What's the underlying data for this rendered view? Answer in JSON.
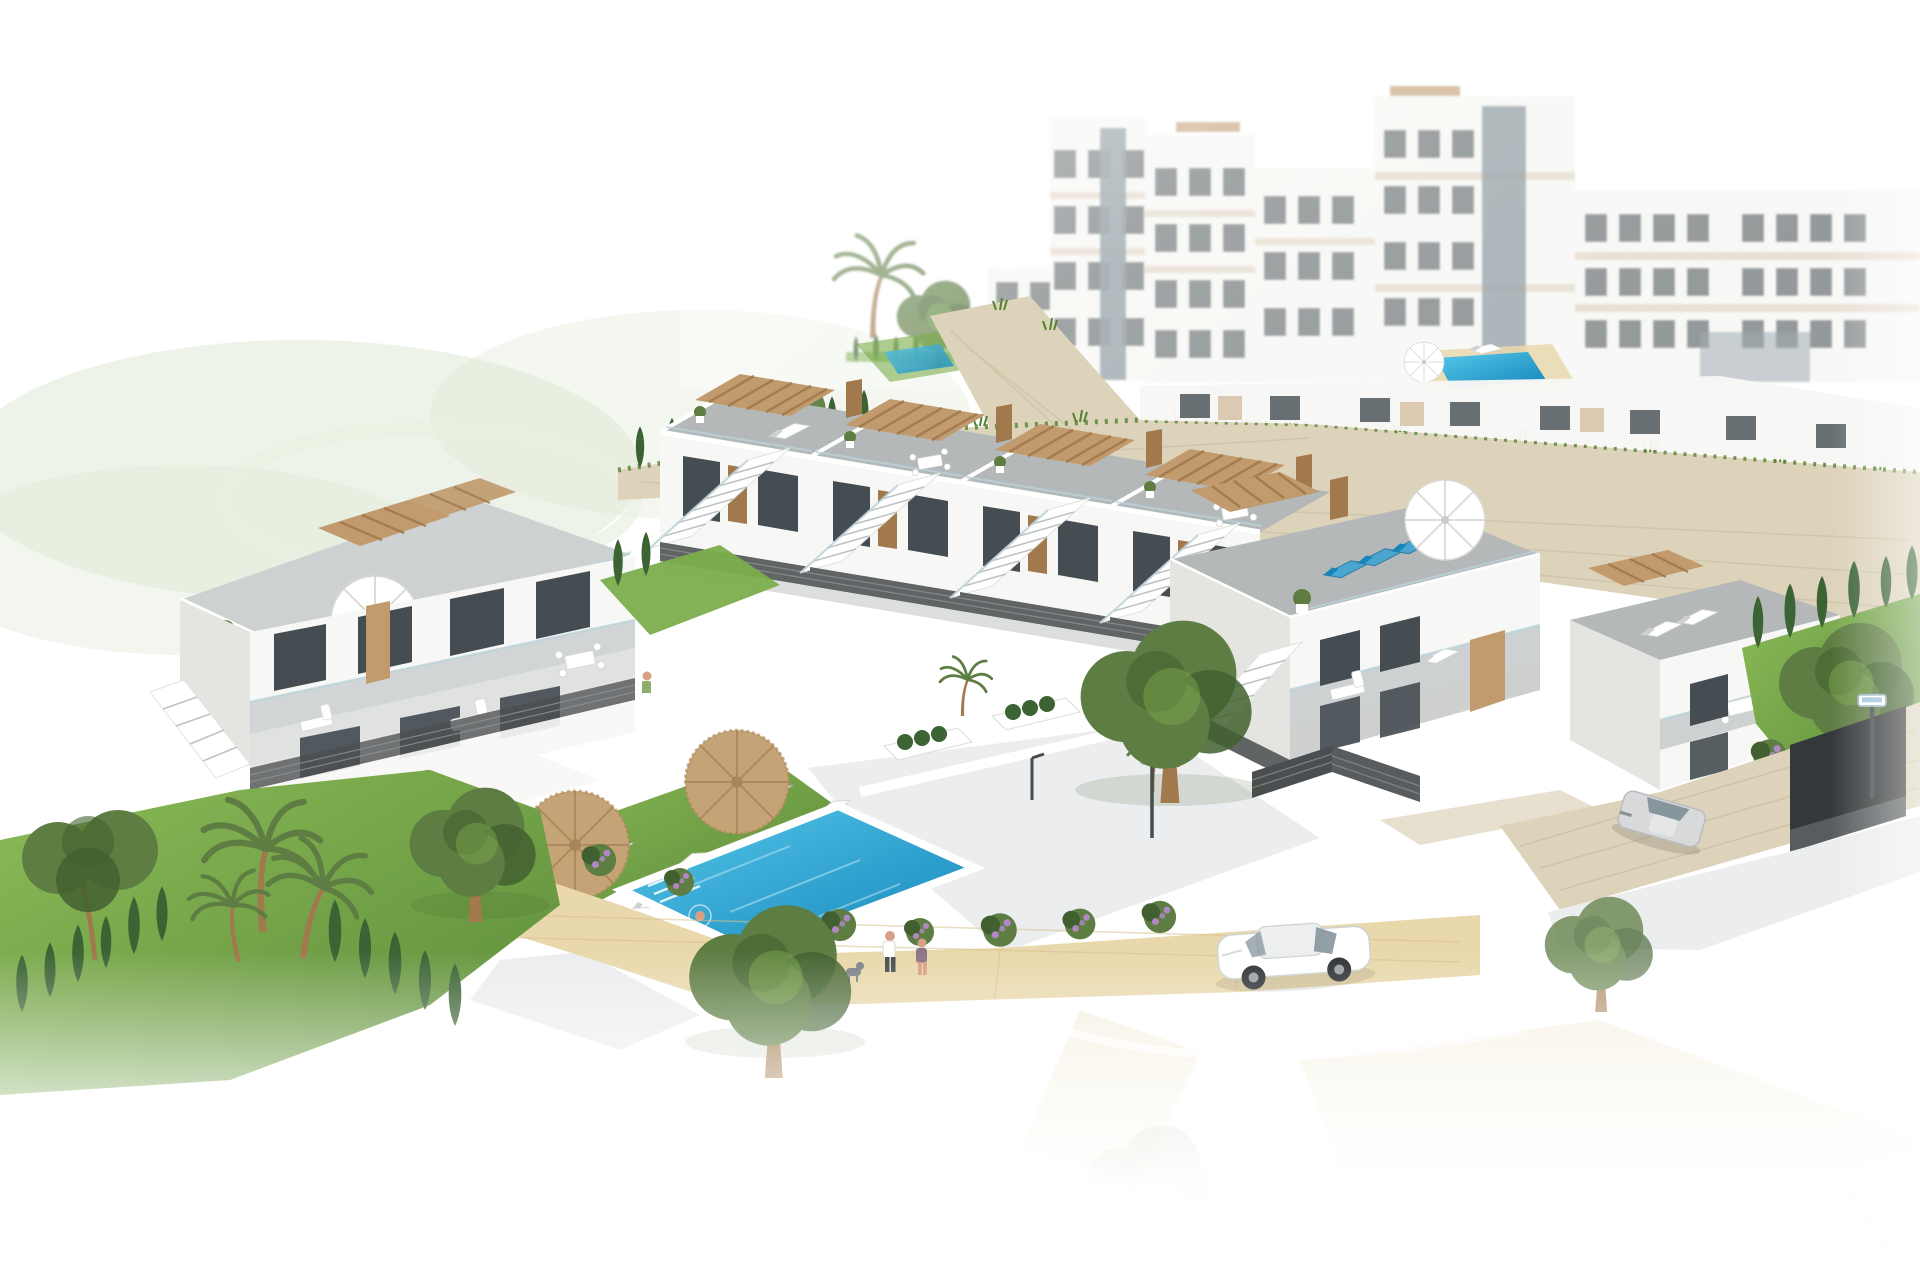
{
  "meta": {
    "type": "architectural-3d-render",
    "subject": "Aerial 3D rendering of a modern white townhouse development on a hillside with roof terraces, wooden pergolas, a communal turquoise pool, landscaped gardens, a street with cars and hazy apartment blocks in the background; edges fade to white",
    "style": "photorealistic CGI marketing visual, white vignette background",
    "camera": "high-angle aerial, isometric-like"
  },
  "colors": {
    "bg": "#ffffff",
    "facade": "#f7f7f5",
    "facadeShade": "#e4e4e1",
    "facadeDark": "#d3d3d0",
    "glass": "#454d52",
    "glassLight": "#87959c",
    "wood": "#c19b6e",
    "woodDark": "#a2794c",
    "deck": "#b4b8b9",
    "deckLight": "#ced1d1",
    "stone": "#ddd3bb",
    "stoneDark": "#c4b795",
    "lawn": "#7cad4c",
    "lawnDark": "#53822f",
    "golf": "#dfe9d5",
    "tree": "#5e7d43",
    "treeDark": "#42602f",
    "cypress": "#3b6334",
    "pool": "#2ba8d8",
    "poolDeep": "#1584b8",
    "sand": "#e9d8ab",
    "sandDark": "#d8c18c",
    "umbrella": "#c4a377",
    "umbrellaDark": "#a88659",
    "fence": "#4b4e50",
    "road": "#ecedee",
    "carSilver": "#d7d9db",
    "skin": "#d8a084",
    "bikini": "#e2519c",
    "flower": "#b287c4",
    "loungerBlue": "#4aa6d0",
    "rail": "#b9d2da"
  },
  "labels": {
    "scene": "Residential development aerial render",
    "background_apartments": "Hazy multi-storey apartment blocks in the background",
    "rooftop_mini_pool": "Rooftop terrace plunge pool with deck",
    "upper_garden": "Small upper garden with plunge pool",
    "retaining_wall": "Natural stone retaining walls with wild grasses",
    "back_house_band": "Second row of homes behind the stone wall",
    "townhouse_row": "Front row of white townhouses with roof solariums and wooden pergolas",
    "end_house": "Corner townhouse with wrap-around roof terrace, blue loungers and white parasol",
    "right_house": "Right-hand townhouse with stacked terraces",
    "right_garden": "Private garden with cypress hedge and olive tree",
    "left_block": "Left townhouse block with roof solarium and parasol",
    "pool_area": "Communal pool area",
    "swimming_pool": "Turquoise swimming pool with white coping",
    "sunbathing_lawn": "Lawn with white sun loungers and straw parasols",
    "promenade": "Sand-coloured promenade with flowering hedge",
    "pedestrians": "Couple walking a small dog",
    "sunbather": "Woman sunbathing on a lounger",
    "swimmer": "Person in the pool",
    "terrace_person": "Resident on an upper terrace",
    "garage": "Underground garage entrance in stone wall",
    "silver_car": "Silver car on the garage driveway",
    "white_car": "White saloon car parked on the street",
    "street_lamps": "Solar street lamps",
    "left_garden": "Left garden with pine, palms and cypress hedges",
    "road": "Street fading to white in the foreground",
    "golf_green": "Pale golf-course green fading out on the left"
  },
  "inventory": {
    "townhouses_front_row": 6,
    "left_block_homes": 2,
    "rooftop_pergolas": 7,
    "straw_parasols": 2,
    "white_parasols": 2,
    "pool_loungers": 11,
    "rooftop_loungers": 7,
    "people": 5,
    "dogs": 1,
    "cars": 2,
    "street_lamps": 2,
    "palm_trees": 5,
    "swimming_pools": 3
  }
}
